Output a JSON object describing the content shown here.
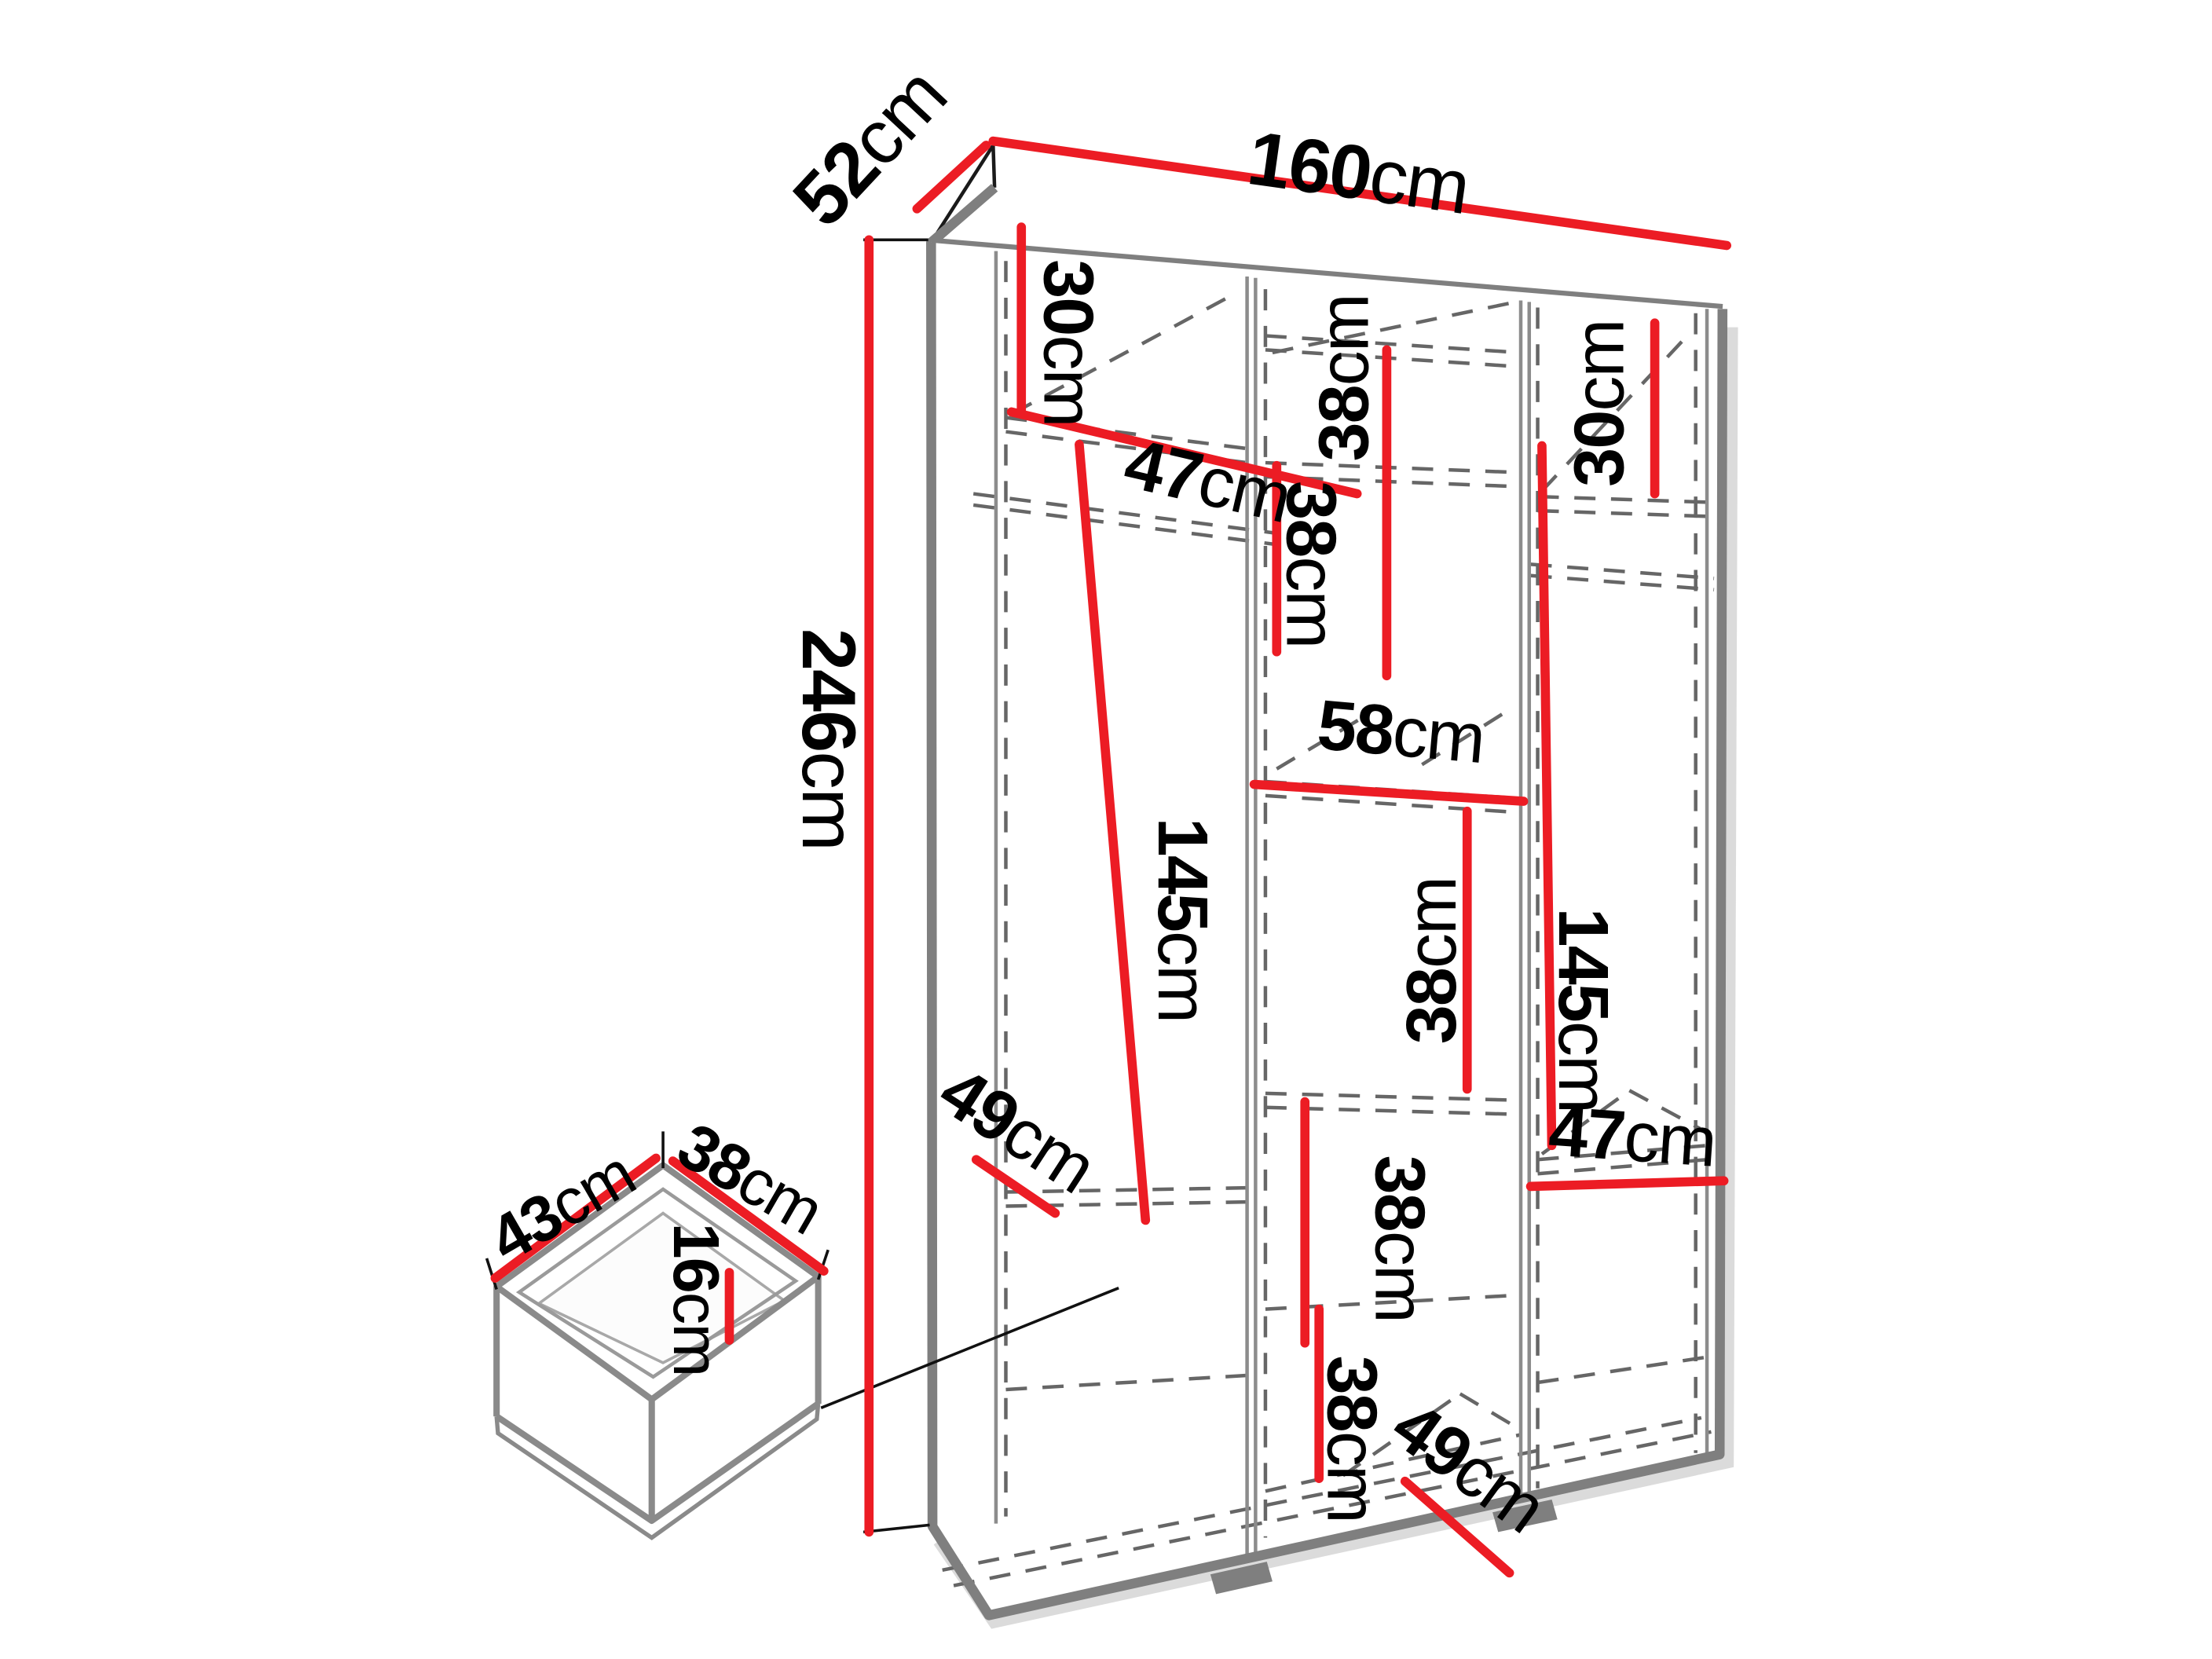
{
  "diagram": {
    "type": "wardrobe-dimension-diagram",
    "unit": "cm",
    "colors": {
      "dimension_line": "#ec1c24",
      "outline": "#7f7f7f",
      "hidden_line": "#666666",
      "label_text": "#000000",
      "background": "#ffffff"
    },
    "dims": {
      "width": {
        "value": "160",
        "unit": "cm"
      },
      "depth": {
        "value": "52",
        "unit": "cm"
      },
      "height": {
        "value": "246",
        "unit": "cm"
      },
      "left_top_shelf": {
        "value": "30",
        "unit": "cm"
      },
      "left_shelf_width": {
        "value": "47",
        "unit": "cm"
      },
      "mid_cell_1": {
        "value": "38",
        "unit": "cm"
      },
      "right_top_shelf": {
        "value": "30",
        "unit": "cm"
      },
      "mid_cell_2": {
        "value": "38",
        "unit": "cm"
      },
      "mid_shelf_width": {
        "value": "58",
        "unit": "cm"
      },
      "mid_cell_3": {
        "value": "38",
        "unit": "cm"
      },
      "left_hanging_height": {
        "value": "145",
        "unit": "cm"
      },
      "right_hanging_height": {
        "value": "145",
        "unit": "cm"
      },
      "left_shelf_depth": {
        "value": "49",
        "unit": "cm"
      },
      "right_shelf_width": {
        "value": "47",
        "unit": "cm"
      },
      "mid_cell_4": {
        "value": "38",
        "unit": "cm"
      },
      "mid_cell_5": {
        "value": "38",
        "unit": "cm"
      },
      "mid_floor_depth": {
        "value": "49",
        "unit": "cm"
      },
      "drawer_width": {
        "value": "43",
        "unit": "cm"
      },
      "drawer_depth": {
        "value": "38",
        "unit": "cm"
      },
      "drawer_height": {
        "value": "16",
        "unit": "cm"
      }
    }
  }
}
